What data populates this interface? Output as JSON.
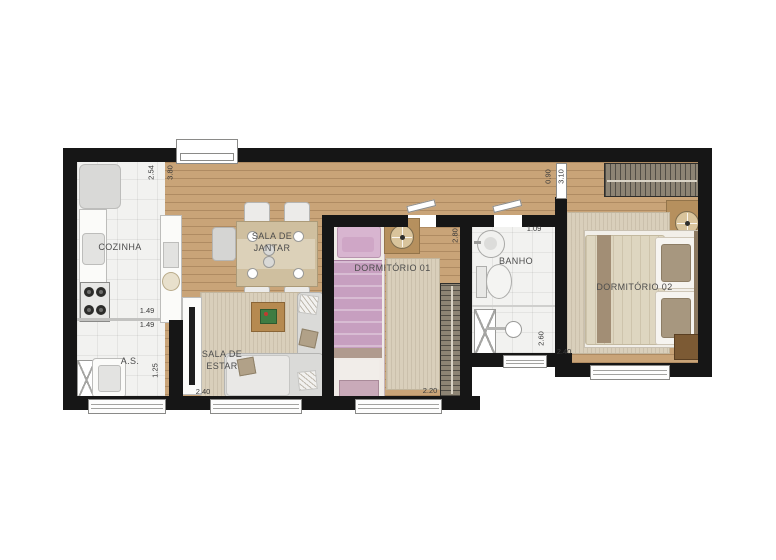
{
  "plan": {
    "type": "apartment-floor-plan",
    "rooms": {
      "cozinha": {
        "label": "COZINHA"
      },
      "sala_jantar": {
        "label": "SALA DE\nJANTAR"
      },
      "sala_estar": {
        "label": "SALA DE\nESTAR"
      },
      "area_servico": {
        "label": "A.S."
      },
      "dormitorio1": {
        "label": "DORMITÓRIO 01"
      },
      "banho": {
        "label": "BANHO"
      },
      "dormitorio2": {
        "label": "DORMITÓRIO 02"
      }
    },
    "dimensions": {
      "cozinha_depth": "2.54",
      "sala_depth": "3.80",
      "bancada_sup": "1.49",
      "bancada_inf": "1.49",
      "as_width": "1.25",
      "sala_estar_width": "2.40",
      "dorm1_width": "2.20",
      "dorm1_depth": "2.80",
      "banho_width": "1.09",
      "banho_depth": "2.60",
      "hall_width": "0.90",
      "dorm2_depth": "3.10",
      "dorm2_width": "2.40"
    },
    "colors": {
      "wall": "#161616",
      "wood_floor": "#c9a478",
      "tile_floor": "#f2f2f0",
      "rug": "#d9cfbb",
      "bed1_pink": "#c79fc0",
      "bed2_blanket": "#ded6c0",
      "sofa": "#dadad8",
      "wardrobe": "#8d8474",
      "label_text": "#4c4c4c"
    }
  }
}
